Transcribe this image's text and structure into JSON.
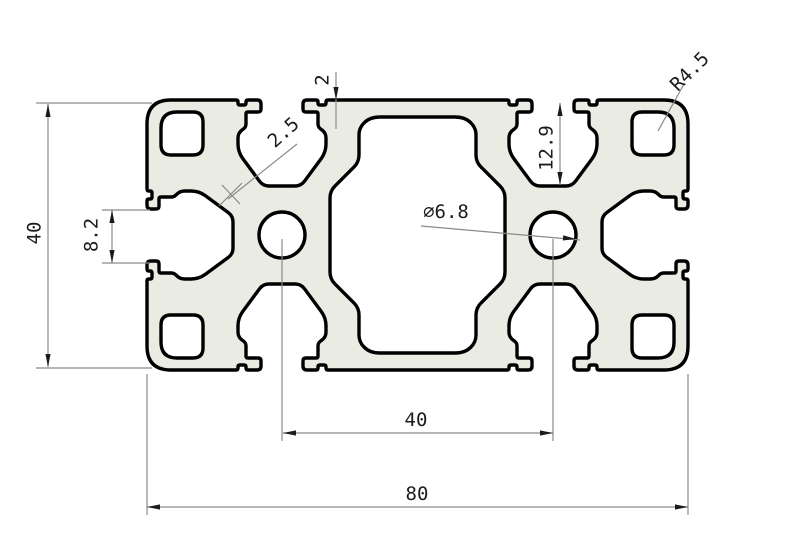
{
  "drawing": {
    "title": "aluminum extrusion profile 4080 cross-section",
    "dims": {
      "height": "40",
      "slot_opening": "8.2",
      "web_thickness": "2.5",
      "wall_thickness": "2",
      "slot_depth": "12.9",
      "hole_diameter": "∅6.8",
      "corner_radius": "R4.5",
      "hole_spacing": "40",
      "width": "80"
    },
    "colors": {
      "material_fill": "#eaece3",
      "outline": "#000000",
      "dimension_lines": "#8a8a8a",
      "text": "#1c1c1c",
      "background": "#ffffff"
    }
  }
}
